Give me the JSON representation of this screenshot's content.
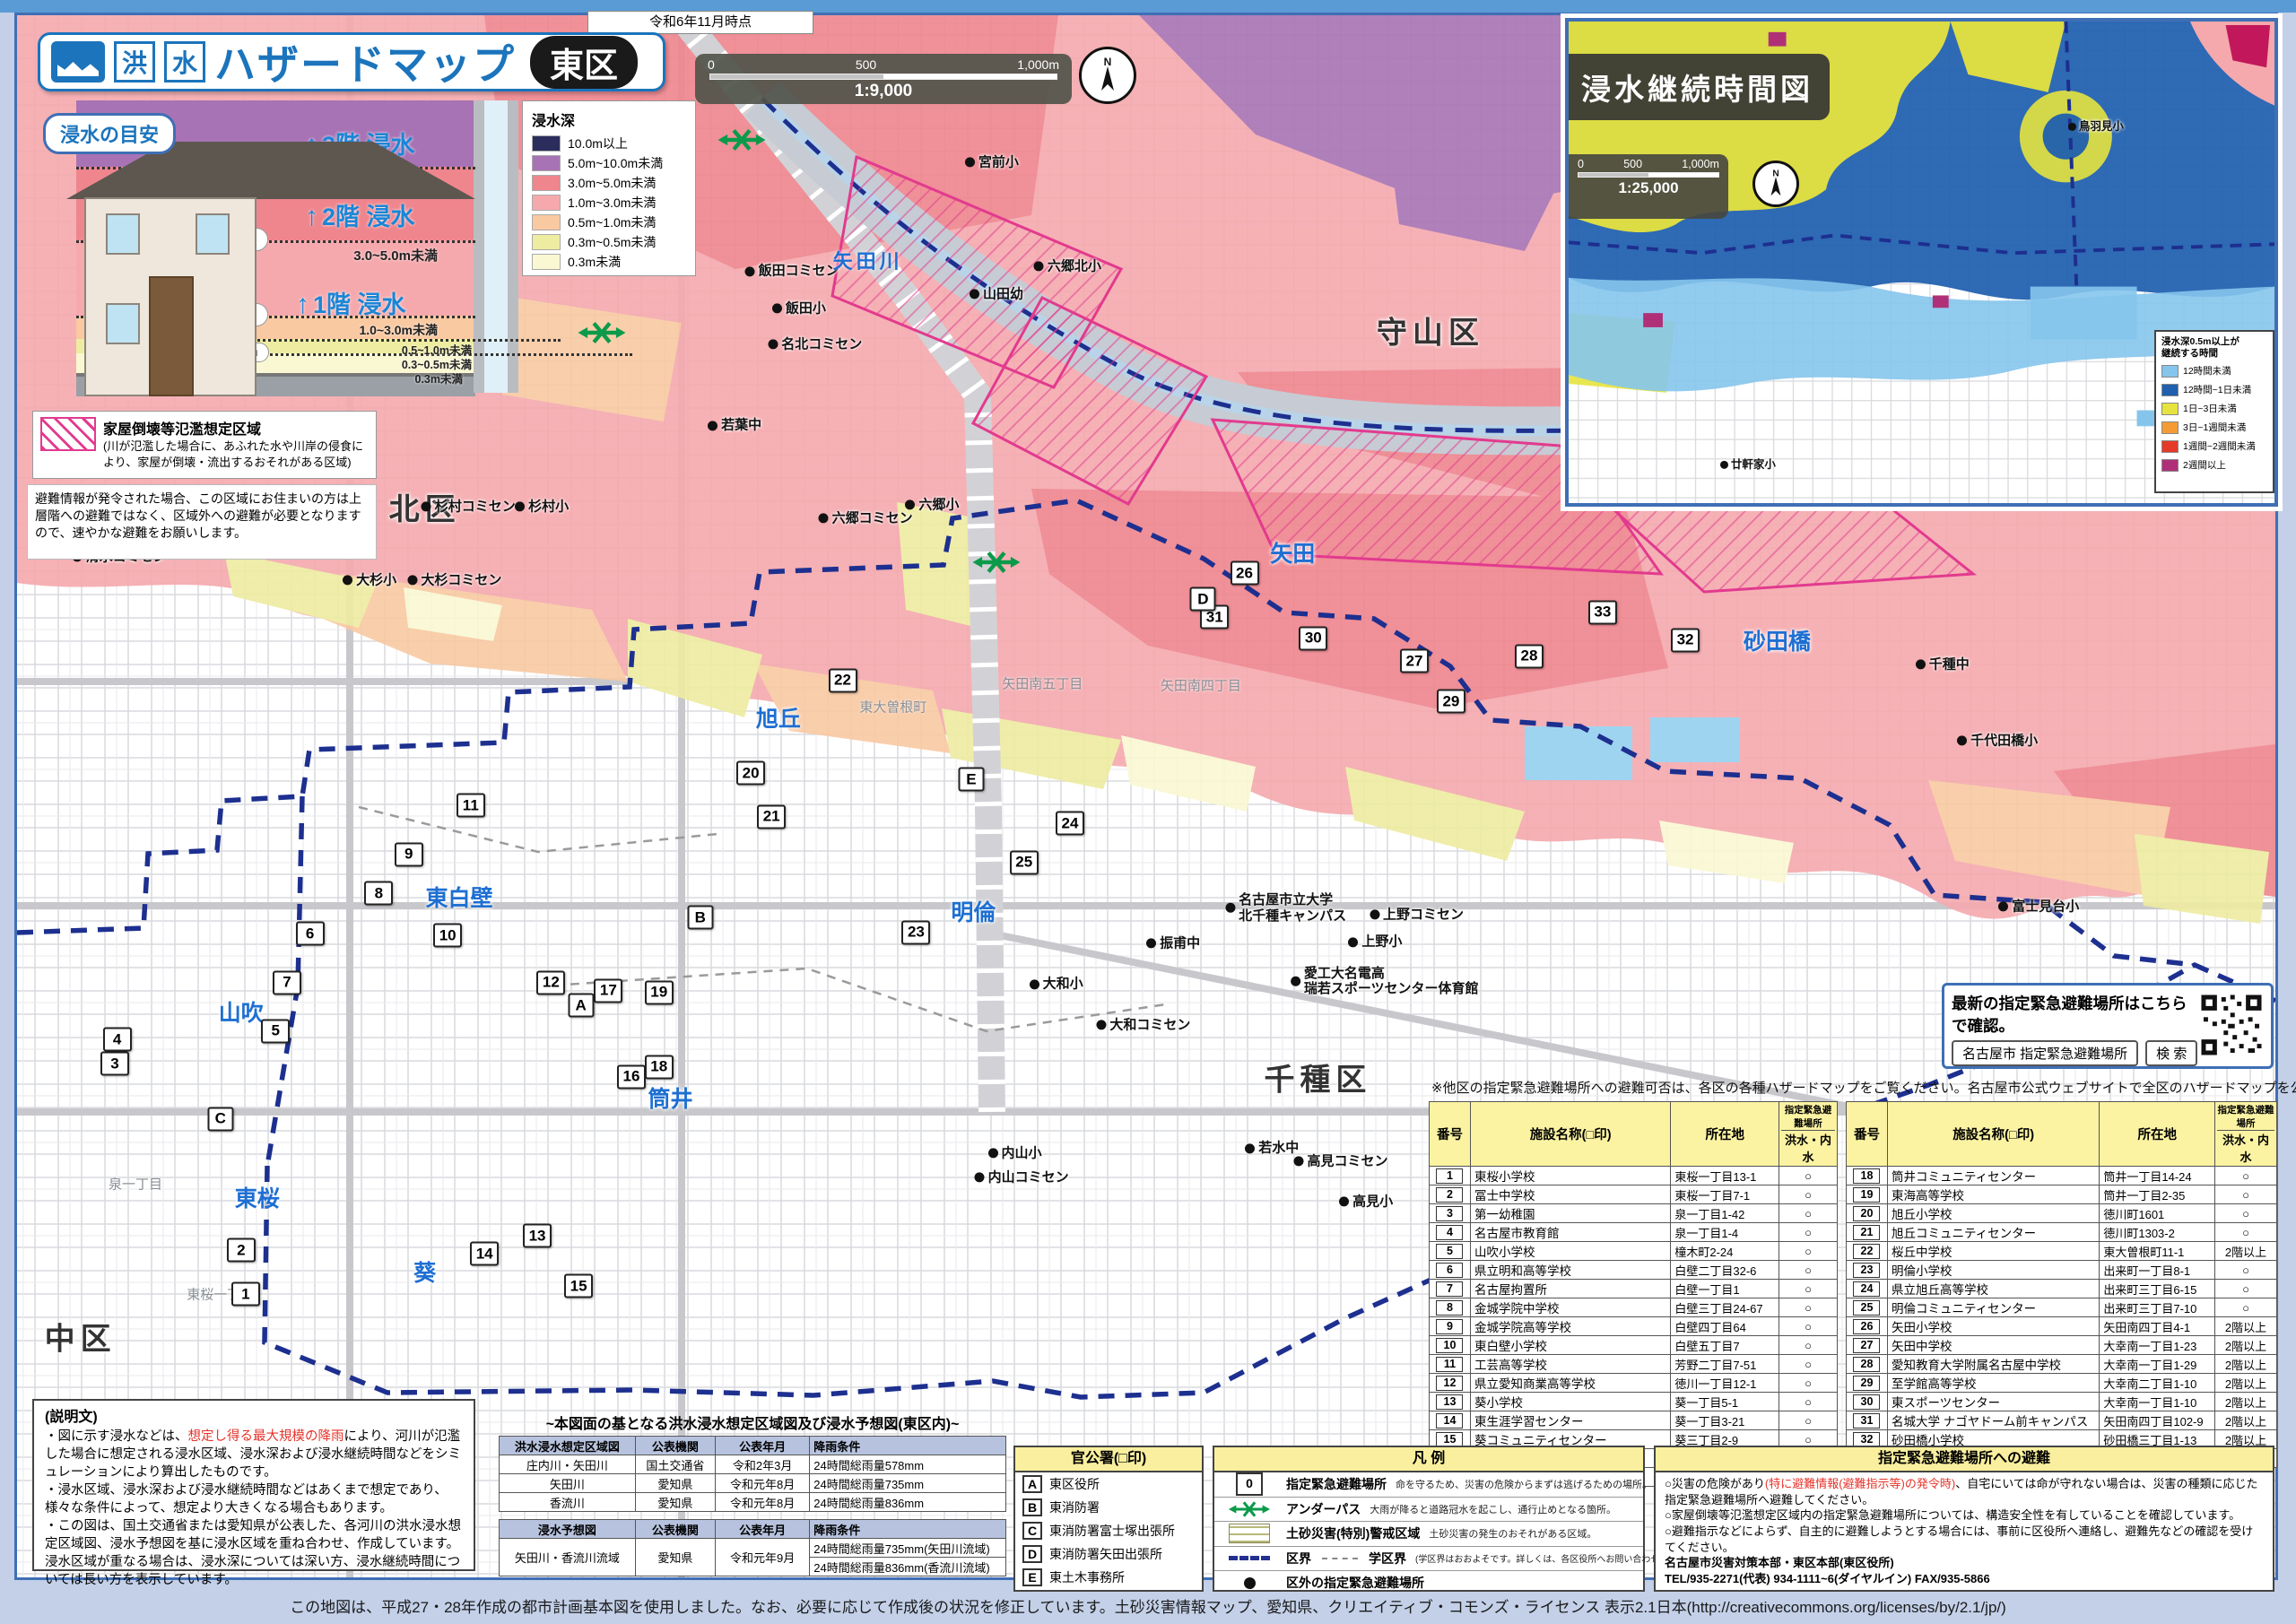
{
  "meta": {
    "as_of": "令和6年11月時点",
    "footer": "この地図は、平成27・28年作成の都市計画基本図を使用しました。なお、必要に応じて作成後の状況を修正しています。土砂災害情報マップ、愛知県、クリエイティブ・コモンズ・ライセンス 表示2.1日本(http://creativecommons.org/licenses/by/2.1/jp/)"
  },
  "title": {
    "kanji1": "洪",
    "kanji2": "水",
    "main": "ハザードマップ",
    "ward": "東区"
  },
  "scale_bar": {
    "zero": "0",
    "mid": "500",
    "end": "1,000m",
    "ratio": "1:9,000"
  },
  "depth_legend": {
    "title": "浸水深",
    "items": [
      {
        "label": "10.0m以上",
        "color": "#2b2d5c"
      },
      {
        "label": "5.0m~10.0m未満",
        "color": "#a873b4"
      },
      {
        "label": "3.0m~5.0m未満",
        "color": "#ef858d"
      },
      {
        "label": "1.0m~3.0m未満",
        "color": "#f5a9ad"
      },
      {
        "label": "0.5m~1.0m未満",
        "color": "#f9c9a2"
      },
      {
        "label": "0.3m~0.5m未満",
        "color": "#eeeca0"
      },
      {
        "label": "0.3m未満",
        "color": "#faf8d2"
      }
    ]
  },
  "guide": {
    "title": "浸水の目安",
    "top_label": "5.0m以上",
    "mid_label1": "3.0~5.0m未満",
    "mid_label2": "1.0~3.0m未満",
    "small_label1": "0.5~1.0m未満",
    "small_label2": "0.3~0.5m未満",
    "small_label3": "0.3m未満",
    "pill_50": "5.0m",
    "pill_30": "3.0m",
    "pill_10": "1.0m",
    "pill_05": "0.5m",
    "pill_03": "0.3m",
    "floor3": "3階 浸水",
    "floor2": "2階 浸水",
    "floor1": "1階 浸水"
  },
  "hatch_box": {
    "title": "家屋倒壊等氾濫想定区域",
    "body": "(川が氾濫した場合に、あふれた水や川岸の侵食により、家屋が倒壊・流出するおそれがある区域)"
  },
  "evac_note": "避難情報が発令された場合、この区域にお住まいの方は上層階への避難ではなく、区域外への避難が必要となりますので、速やかな避難をお願いします。",
  "inset": {
    "title": "浸水継続時間図",
    "scale": {
      "zero": "0",
      "mid": "500",
      "end": "1,000m",
      "ratio": "1:25,000"
    },
    "legend_title": "浸水深0.5m以上が\n継続する時間",
    "legend": [
      {
        "label": "12時間未満",
        "color": "#85c5ec"
      },
      {
        "label": "12時間~1日未満",
        "color": "#1f5fae"
      },
      {
        "label": "1日~3日未満",
        "color": "#e6e33e"
      },
      {
        "label": "3日~1週間未満",
        "color": "#f59b35"
      },
      {
        "label": "1週間~2週間未満",
        "color": "#e63a28"
      },
      {
        "label": "2週間以上",
        "color": "#b03078"
      }
    ],
    "facilities": [
      {
        "name": "鳥羽見小",
        "x": 74.7,
        "y": 21.8
      },
      {
        "name": "廿軒家小",
        "x": 25.4,
        "y": 92.0
      }
    ]
  },
  "qr_box": {
    "text": "最新の指定緊急避難場所はこちらで確認。",
    "keyword": "名古屋市  指定緊急避難場所",
    "button": "検 索"
  },
  "table_note": "※他区の指定緊急避難場所への避難可否は、各区の各種ハザードマップをご覧ください。名古屋市公式ウェブサイトで全区のハザードマップを公開しています。",
  "shelter_table": {
    "h_no": "番号",
    "h_name": "施設名称(□印)",
    "h_addr": "所在地",
    "h_flood1": "指定緊急避難場所",
    "h_flood2": "洪水・内水",
    "rows": [
      [
        "1",
        "東桜小学校",
        "東桜一丁目13-1",
        "○"
      ],
      [
        "2",
        "冨士中学校",
        "東桜一丁目7-1",
        "○"
      ],
      [
        "3",
        "第一幼稚園",
        "泉一丁目1-42",
        "○"
      ],
      [
        "4",
        "名古屋市教育館",
        "泉一丁目1-4",
        "○"
      ],
      [
        "5",
        "山吹小学校",
        "橦木町2-24",
        "○"
      ],
      [
        "6",
        "県立明和高等学校",
        "白壁二丁目32-6",
        "○"
      ],
      [
        "7",
        "名古屋拘置所",
        "白壁一丁目1",
        "○"
      ],
      [
        "8",
        "金城学院中学校",
        "白壁三丁目24-67",
        "○"
      ],
      [
        "9",
        "金城学院高等学校",
        "白壁四丁目64",
        "○"
      ],
      [
        "10",
        "東白壁小学校",
        "白壁五丁目7",
        "○"
      ],
      [
        "11",
        "工芸高等学校",
        "芳野二丁目7-51",
        "○"
      ],
      [
        "12",
        "県立愛知商業高等学校",
        "徳川一丁目12-1",
        "○"
      ],
      [
        "13",
        "葵小学校",
        "葵一丁目5-1",
        "○"
      ],
      [
        "14",
        "東生涯学習センター",
        "葵一丁目3-21",
        "○"
      ],
      [
        "15",
        "葵コミュニティセンター",
        "葵三丁目2-9",
        "○"
      ],
      [
        "16",
        "筒井小学校",
        "筒井一丁目15-28",
        "○"
      ],
      [
        "17",
        "あずま中学校",
        "筒井一丁目1-1",
        "○"
      ],
      [
        "18",
        "筒井コミュニティセンター",
        "筒井一丁目14-24",
        "○"
      ],
      [
        "19",
        "東海高等学校",
        "筒井一丁目2-35",
        "○"
      ],
      [
        "20",
        "旭丘小学校",
        "徳川町1601",
        "○"
      ],
      [
        "21",
        "旭丘コミュニティセンター",
        "徳川町1303-2",
        "○"
      ],
      [
        "22",
        "桜丘中学校",
        "東大曽根町11-1",
        "2階以上"
      ],
      [
        "23",
        "明倫小学校",
        "出来町一丁目8-1",
        "○"
      ],
      [
        "24",
        "県立旭丘高等学校",
        "出来町三丁目6-15",
        "○"
      ],
      [
        "25",
        "明倫コミュニティセンター",
        "出来町三丁目7-10",
        "○"
      ],
      [
        "26",
        "矢田小学校",
        "矢田南四丁目4-1",
        "2階以上"
      ],
      [
        "27",
        "矢田中学校",
        "大幸南一丁目1-23",
        "2階以上"
      ],
      [
        "28",
        "愛知教育大学附属名古屋中学校",
        "大幸南一丁目1-29",
        "2階以上"
      ],
      [
        "29",
        "至学館高等学校",
        "大幸南二丁目1-10",
        "2階以上"
      ],
      [
        "30",
        "東スポーツセンター",
        "大幸南一丁目1-10",
        "2階以上"
      ],
      [
        "31",
        "名城大学 ナゴヤドーム前キャンパス",
        "矢田南四丁目102-9",
        "2階以上"
      ],
      [
        "32",
        "砂田橋小学校",
        "砂田橋三丁目1-13",
        "2階以上"
      ],
      [
        "33",
        "名古屋中学校・名古屋高等学校",
        "砂田橋二丁目1-58",
        "2階以上"
      ]
    ]
  },
  "description_box": {
    "title": "(説明文)",
    "b1_pre": "・図に示す浸水などは、",
    "b1_red": "想定し得る最大規模の降雨",
    "b1_post": "により、河川が氾濫した場合に想定される浸水区域、浸水深および浸水継続時間などをシミュレーションにより算出したものです。",
    "b2": "・浸水区域、浸水深および浸水継続時間などはあくまで想定であり、様々な条件によって、想定より大きくなる場合もあります。",
    "b3": "・この図は、国土交通省または愛知県が公表した、各河川の洪水浸水想定区域図、浸水予想図を基に浸水区域を重ね合わせ、作成しています。浸水区域が重なる場合は、浸水深については深い方、浸水継続時間については長い方を表示しています。"
  },
  "source_tables": {
    "title": "~本図面の基となる洪水浸水想定区域図及び浸水予想図(東区内)~",
    "t1": {
      "headers": [
        "洪水浸水想定区域図",
        "公表機関",
        "公表年月",
        "降雨条件"
      ],
      "rows": [
        [
          "庄内川・矢田川",
          "国土交通省",
          "令和2年3月",
          "24時間総雨量578mm"
        ],
        [
          "矢田川",
          "愛知県",
          "令和元年8月",
          "24時間総雨量735mm"
        ],
        [
          "香流川",
          "愛知県",
          "令和元年8月",
          "24時間総雨量836mm"
        ]
      ]
    },
    "t2": {
      "headers": [
        "浸水予想図",
        "公表機関",
        "公表年月",
        "降雨条件"
      ],
      "row": [
        "矢田川・香流川流域",
        "愛知県",
        "令和元年9月"
      ],
      "cond1": "24時間総雨量735mm(矢田川流域)",
      "cond2": "24時間総雨量836mm(香流川流域)"
    }
  },
  "offices": {
    "header": "官公署(□印)",
    "items": [
      {
        "mark": "A",
        "name": "東区役所"
      },
      {
        "mark": "B",
        "name": "東消防署"
      },
      {
        "mark": "C",
        "name": "東消防署富士塚出張所"
      },
      {
        "mark": "D",
        "name": "東消防署矢田出張所"
      },
      {
        "mark": "E",
        "name": "東土木事務所"
      }
    ]
  },
  "legend_box": {
    "header": "凡 例",
    "r1_sym": "0",
    "r1_title": "指定緊急避難場所",
    "r1_desc": "命を守るため、災害の危険からまずは逃げるための場所。",
    "r2_title": "アンダーパス",
    "r2_desc": "大雨が降ると道路冠水を起こし、通行止めとなる箇所。",
    "r3_title": "土砂災害(特別)警戒区域",
    "r3_desc": "土砂災害の発生のおそれがある区域。",
    "r4_title": "区界",
    "r4_title2": "学区界",
    "r4_desc": "(学区界はおおよそです。詳しくは、各区役所へお問い合わせください。)",
    "r5_title": "区外の指定緊急避難場所"
  },
  "evacuation_box": {
    "header": "指定緊急避難場所への避難",
    "l1_pre": "○災害の危険があり",
    "l1_red": "(特に避難情報(避難指示等)の発令時)",
    "l1_post": "、自宅にいては命が守れない場合は、災害の種類に応じた指定緊急避難場所へ避難してください。",
    "l2": "○家屋倒壊等氾濫想定区域内の指定緊急避難場所については、構造安全性を有していることを確認しています。",
    "l3": "○避難指示などによらず、自主的に避難しようとする場合には、事前に区役所へ連絡し、避難先などの確認を受けてください。",
    "contact1": "名古屋市災害対策本部・東区本部(東区役所)",
    "contact2": "TEL/935-2271(代表) 934-1111~6(ダイヤルイン)  FAX/935-5866"
  },
  "map": {
    "river": {
      "name": "矢田川",
      "x": 37.8,
      "y": 16.0
    },
    "wards": [
      {
        "name": "北区",
        "x": 18.5,
        "y": 31.2
      },
      {
        "name": "守山区",
        "x": 62.3,
        "y": 20.3
      },
      {
        "name": "千種区",
        "x": 57.4,
        "y": 66.3
      },
      {
        "name": "中区",
        "x": 3.5,
        "y": 82.3
      }
    ],
    "districts": [
      {
        "name": "旭丘",
        "x": 33.9,
        "y": 44.2
      },
      {
        "name": "東白壁",
        "x": 20.0,
        "y": 55.2
      },
      {
        "name": "山吹",
        "x": 10.5,
        "y": 62.3
      },
      {
        "name": "明倫",
        "x": 42.4,
        "y": 56.1
      },
      {
        "name": "筒井",
        "x": 29.2,
        "y": 67.6
      },
      {
        "name": "葵",
        "x": 18.5,
        "y": 78.3
      },
      {
        "name": "東桜",
        "x": 11.2,
        "y": 73.7
      },
      {
        "name": "矢田",
        "x": 56.3,
        "y": 34.0
      },
      {
        "name": "砂田橋",
        "x": 77.4,
        "y": 39.4
      }
    ],
    "towns": [
      {
        "name": "東大曽根町",
        "x": 38.9,
        "y": 43.5
      },
      {
        "name": "矢田南五丁目",
        "x": 45.4,
        "y": 42.1
      },
      {
        "name": "矢田南四丁目",
        "x": 52.3,
        "y": 42.2
      },
      {
        "name": "泉一丁目",
        "x": 5.9,
        "y": 72.9
      },
      {
        "name": "東桜一丁目",
        "x": 9.6,
        "y": 79.7
      }
    ],
    "facilities": [
      {
        "name": "清水コミセン",
        "x": 5.2,
        "y": 34.3
      },
      {
        "name": "大杉小",
        "x": 16.1,
        "y": 35.7
      },
      {
        "name": "大杉コミセン",
        "x": 19.8,
        "y": 35.7
      },
      {
        "name": "杉村コミセン",
        "x": 20.4,
        "y": 31.2
      },
      {
        "name": "杉村小",
        "x": 23.6,
        "y": 31.2
      },
      {
        "name": "若葉中",
        "x": 32.0,
        "y": 26.2
      },
      {
        "name": "飯田コミセン",
        "x": 34.5,
        "y": 16.7
      },
      {
        "name": "飯田小",
        "x": 34.8,
        "y": 19.0
      },
      {
        "name": "名北コミセン",
        "x": 35.5,
        "y": 21.2
      },
      {
        "name": "山田幼",
        "x": 43.4,
        "y": 18.1
      },
      {
        "name": "宮前小",
        "x": 43.2,
        "y": 10.0
      },
      {
        "name": "六郷北小",
        "x": 46.5,
        "y": 16.4
      },
      {
        "name": "六郷小",
        "x": 40.6,
        "y": 31.1
      },
      {
        "name": "六郷コミセン",
        "x": 37.7,
        "y": 31.9
      },
      {
        "name": "千種中",
        "x": 84.6,
        "y": 40.9
      },
      {
        "name": "千代田橋小",
        "x": 87.0,
        "y": 45.6
      },
      {
        "name": "富士見台小",
        "x": 88.8,
        "y": 55.8
      },
      {
        "name": "上野コミセン",
        "x": 61.7,
        "y": 56.3
      },
      {
        "name": "上野小",
        "x": 59.9,
        "y": 58.0
      },
      {
        "name": "振甫中",
        "x": 51.1,
        "y": 58.1
      },
      {
        "name": "名古屋市立大学\n北千種キャンパス",
        "x": 56.0,
        "y": 55.9
      },
      {
        "name": "愛工大名電高\n瑞若スポーツセンター体育館",
        "x": 60.3,
        "y": 60.4
      },
      {
        "name": "大和小",
        "x": 46.0,
        "y": 60.6
      },
      {
        "name": "大和コミセン",
        "x": 49.8,
        "y": 63.1
      },
      {
        "name": "若水中",
        "x": 55.4,
        "y": 70.7
      },
      {
        "name": "高見コミセン",
        "x": 58.4,
        "y": 71.5
      },
      {
        "name": "高見小",
        "x": 59.5,
        "y": 74.0
      },
      {
        "name": "内山小",
        "x": 44.2,
        "y": 71.0
      },
      {
        "name": "内山コミセン",
        "x": 44.5,
        "y": 72.5
      }
    ],
    "markers": [
      {
        "n": "1",
        "x": 10.7,
        "y": 79.7
      },
      {
        "n": "2",
        "x": 10.5,
        "y": 77.0
      },
      {
        "n": "3",
        "x": 5.0,
        "y": 65.5
      },
      {
        "n": "4",
        "x": 5.1,
        "y": 64.0
      },
      {
        "n": "5",
        "x": 12.0,
        "y": 63.5
      },
      {
        "n": "6",
        "x": 13.5,
        "y": 57.5
      },
      {
        "n": "7",
        "x": 12.5,
        "y": 60.5
      },
      {
        "n": "8",
        "x": 16.5,
        "y": 55.0
      },
      {
        "n": "9",
        "x": 17.8,
        "y": 52.6
      },
      {
        "n": "10",
        "x": 19.5,
        "y": 57.6
      },
      {
        "n": "11",
        "x": 20.5,
        "y": 49.6
      },
      {
        "n": "12",
        "x": 24.0,
        "y": 60.5
      },
      {
        "n": "13",
        "x": 23.4,
        "y": 76.1
      },
      {
        "n": "14",
        "x": 21.1,
        "y": 77.2
      },
      {
        "n": "15",
        "x": 25.2,
        "y": 79.2
      },
      {
        "n": "16",
        "x": 27.5,
        "y": 66.3
      },
      {
        "n": "17",
        "x": 26.5,
        "y": 61.0
      },
      {
        "n": "18",
        "x": 28.7,
        "y": 65.7
      },
      {
        "n": "19",
        "x": 28.7,
        "y": 61.1
      },
      {
        "n": "20",
        "x": 32.7,
        "y": 47.6
      },
      {
        "n": "21",
        "x": 33.6,
        "y": 50.3
      },
      {
        "n": "22",
        "x": 36.7,
        "y": 41.9
      },
      {
        "n": "23",
        "x": 39.9,
        "y": 57.4
      },
      {
        "n": "24",
        "x": 46.6,
        "y": 50.7
      },
      {
        "n": "25",
        "x": 44.6,
        "y": 53.1
      },
      {
        "n": "26",
        "x": 54.2,
        "y": 35.3
      },
      {
        "n": "27",
        "x": 61.6,
        "y": 40.7
      },
      {
        "n": "28",
        "x": 66.6,
        "y": 40.4
      },
      {
        "n": "29",
        "x": 63.2,
        "y": 43.2
      },
      {
        "n": "30",
        "x": 57.2,
        "y": 39.3
      },
      {
        "n": "31",
        "x": 52.9,
        "y": 38.0
      },
      {
        "n": "32",
        "x": 73.4,
        "y": 39.4
      },
      {
        "n": "33",
        "x": 69.8,
        "y": 37.7
      }
    ],
    "letters": [
      {
        "n": "A",
        "x": 25.3,
        "y": 61.9
      },
      {
        "n": "B",
        "x": 30.5,
        "y": 56.5
      },
      {
        "n": "C",
        "x": 9.6,
        "y": 68.9
      },
      {
        "n": "D",
        "x": 52.4,
        "y": 36.9
      },
      {
        "n": "E",
        "x": 42.3,
        "y": 48.0
      }
    ],
    "underpass": [
      {
        "x": 32.3,
        "y": 8.6
      },
      {
        "x": 26.2,
        "y": 20.5
      },
      {
        "x": 43.4,
        "y": 34.6
      }
    ]
  }
}
